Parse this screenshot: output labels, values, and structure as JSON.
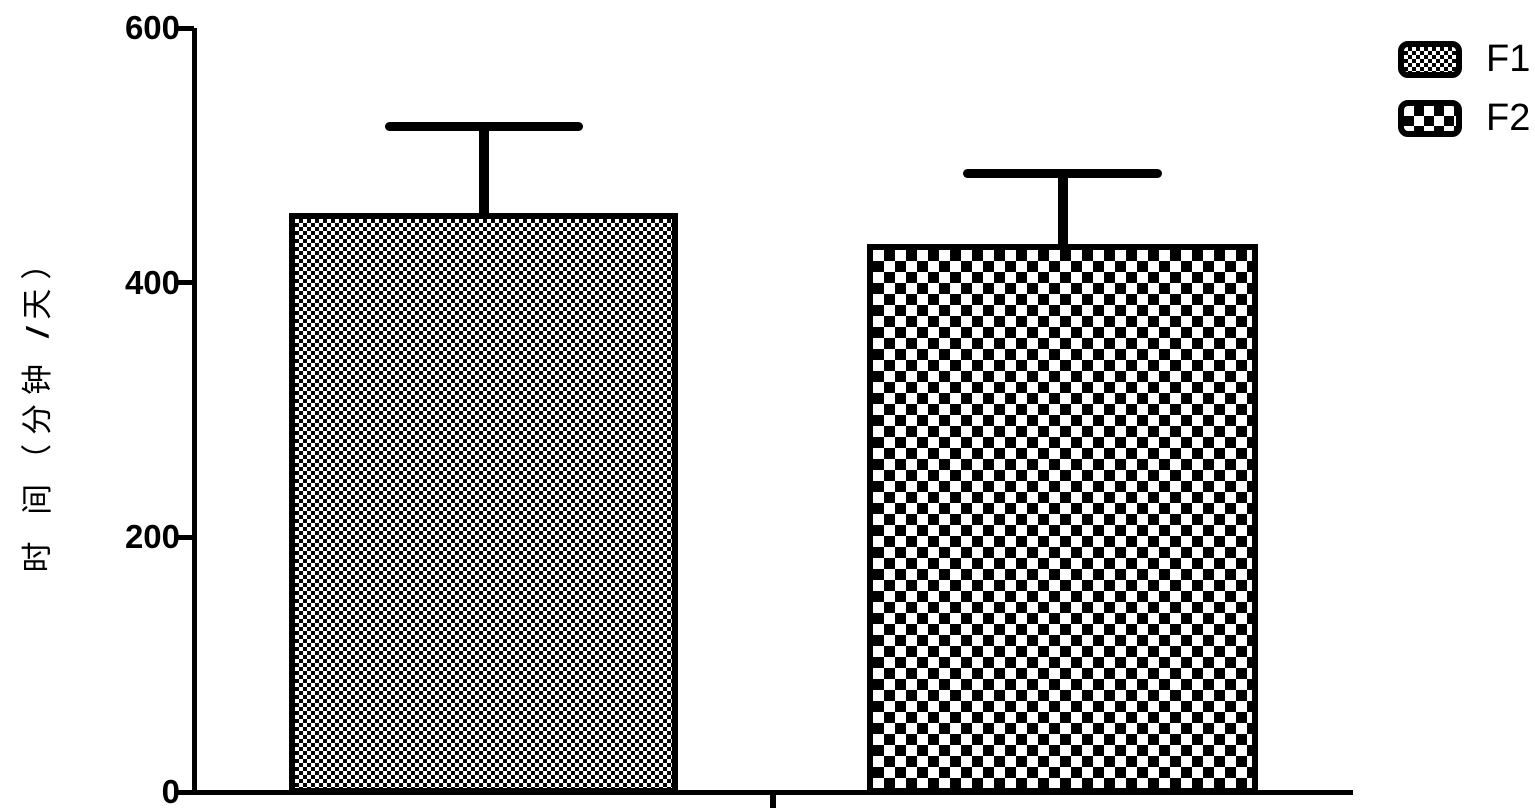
{
  "chart_data": {
    "type": "bar",
    "title": "",
    "xlabel": "",
    "ylabel": "时 间（分钟 /天）",
    "ylabel_parts": {
      "prefix": "时 间（分钟 ",
      "slash": "/",
      "suffix": "天）"
    },
    "ylim": [
      0,
      600
    ],
    "grid": false,
    "legend_position": "top-right",
    "background_color": "#ffffff",
    "foreground_color": "#000000",
    "yticks": [
      {
        "value": 600,
        "label": "600"
      },
      {
        "value": 400,
        "label": "400"
      },
      {
        "value": 200,
        "label": "200"
      },
      {
        "value": 0,
        "label": "0"
      }
    ],
    "categories": [
      "F1",
      "F2"
    ],
    "series": [
      {
        "name": "F1",
        "value": 455,
        "error_upper": 68,
        "error_bar_top": 523,
        "pattern": "fine-checkerboard"
      },
      {
        "name": "F2",
        "value": 430,
        "error_upper": 56,
        "error_bar_top": 486,
        "pattern": "coarse-checkerboard"
      }
    ]
  }
}
